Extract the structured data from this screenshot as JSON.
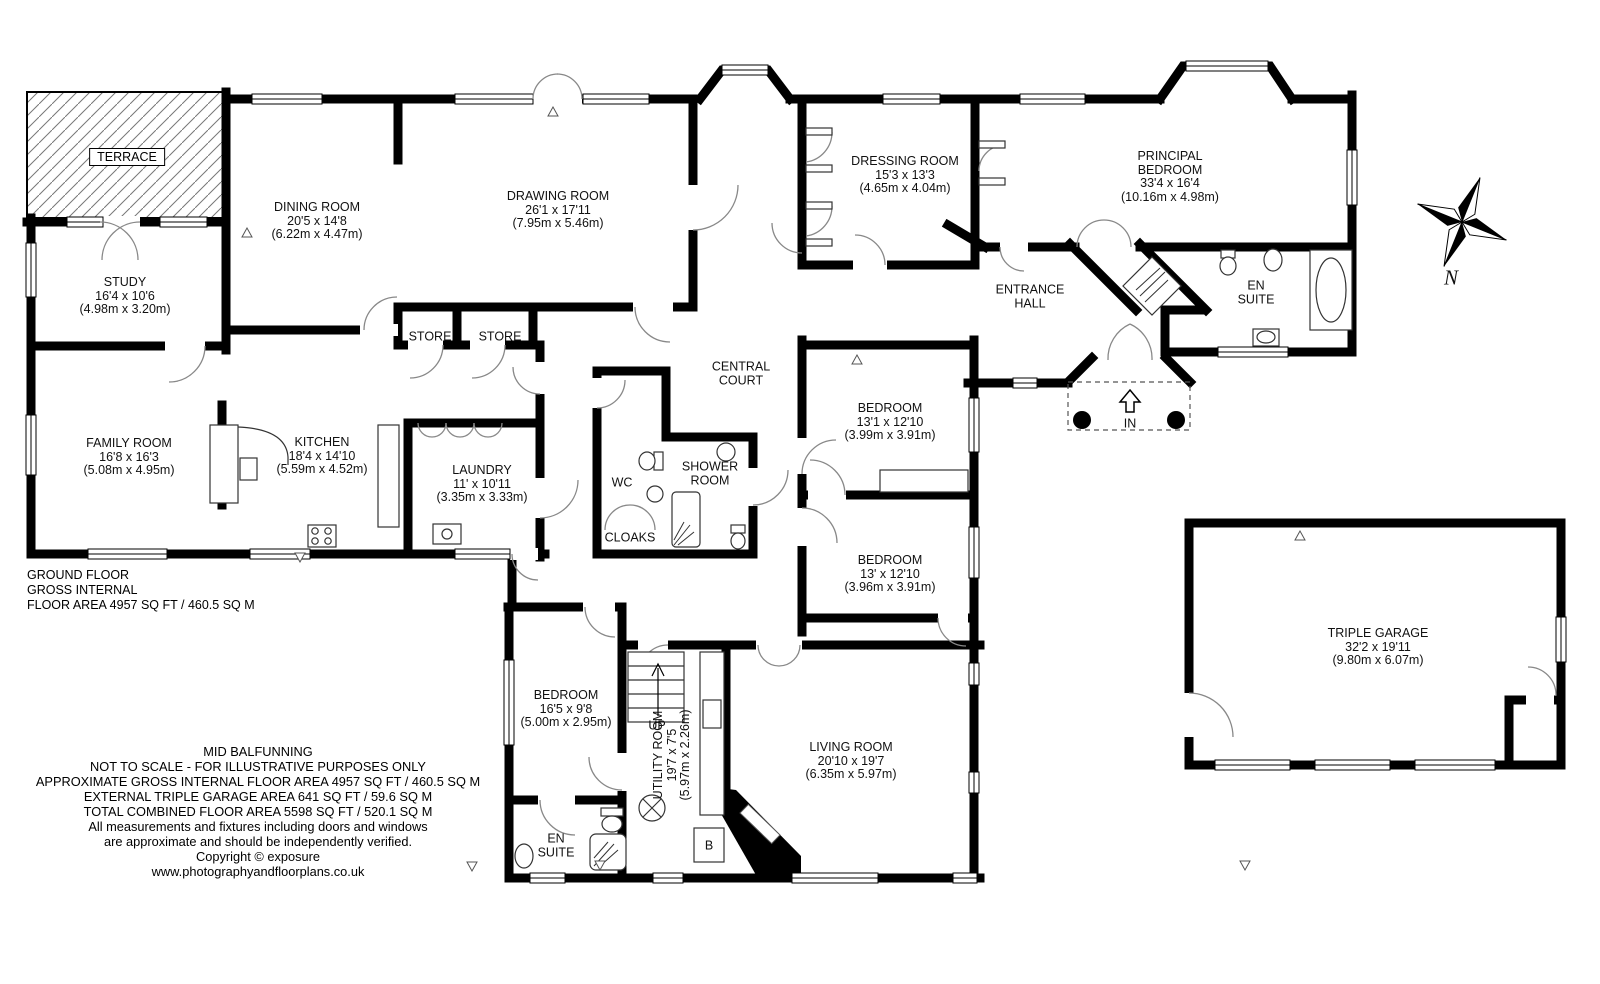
{
  "terrace": {
    "label": "TERRACE"
  },
  "rooms": {
    "study": {
      "name": "STUDY",
      "imperial": "16'4 x 10'6",
      "metric": "(4.98m x 3.20m)"
    },
    "dining_room": {
      "name": "DINING ROOM",
      "imperial": "20'5 x 14'8",
      "metric": "(6.22m x 4.47m)"
    },
    "drawing_room": {
      "name": "DRAWING ROOM",
      "imperial": "26'1 x 17'11",
      "metric": "(7.95m x 5.46m)"
    },
    "store_1": {
      "name": "STORE"
    },
    "store_2": {
      "name": "STORE"
    },
    "family_room": {
      "name": "FAMILY ROOM",
      "imperial": "16'8 x 16'3",
      "metric": "(5.08m x 4.95m)"
    },
    "kitchen": {
      "name": "KITCHEN",
      "imperial": "18'4 x 14'10",
      "metric": "(5.59m x 4.52m)"
    },
    "laundry": {
      "name": "LAUNDRY",
      "imperial": "11' x 10'11",
      "metric": "(3.35m x 3.33m)"
    },
    "wc": {
      "name": "WC"
    },
    "cloaks": {
      "name": "CLOAKS"
    },
    "shower_room": {
      "name": "SHOWER ROOM"
    },
    "central_court": {
      "name": "CENTRAL COURT"
    },
    "dressing_room": {
      "name": "DRESSING ROOM",
      "imperial": "15'3 x 13'3",
      "metric": "(4.65m x 4.04m)"
    },
    "principal_bedroom": {
      "name": "PRINCIPAL BEDROOM",
      "imperial": "33'4 x 16'4",
      "metric": "(10.16m x 4.98m)"
    },
    "entrance_hall": {
      "name": "ENTRANCE HALL"
    },
    "en_suite_principal": {
      "name": "EN SUITE"
    },
    "bedroom_2": {
      "name": "BEDROOM",
      "imperial": "13'1 x 12'10",
      "metric": "(3.99m x 3.91m)"
    },
    "bedroom_3": {
      "name": "BEDROOM",
      "imperial": "13' x 12'10",
      "metric": "(3.96m x 3.91m)"
    },
    "bedroom_4": {
      "name": "BEDROOM",
      "imperial": "16'5 x 9'8",
      "metric": "(5.00m x 2.95m)"
    },
    "en_suite_guest": {
      "name": "EN SUITE"
    },
    "utility_room": {
      "name": "UTILITY ROOM",
      "imperial": "19'7 x 7'5",
      "metric": "(5.97m x 2.26m)"
    },
    "living_room": {
      "name": "LIVING ROOM",
      "imperial": "20'10 x 19'7",
      "metric": "(6.35m x 5.97m)"
    },
    "triple_garage": {
      "name": "TRIPLE GARAGE",
      "imperial": "32'2 x 19'11",
      "metric": "(9.80m x 6.07m)"
    }
  },
  "markers": {
    "up": "UP",
    "in": "IN",
    "boiler": "B",
    "north": "N"
  },
  "floor_summary": {
    "line1": "GROUND FLOOR",
    "line2": "GROSS INTERNAL",
    "line3": "FLOOR AREA 4957 SQ FT / 460.5 SQ M"
  },
  "footer": {
    "property_name": "MID BALFUNNING",
    "scale_note": "NOT TO SCALE - FOR ILLUSTRATIVE PURPOSES ONLY",
    "gross_internal": "APPROXIMATE GROSS INTERNAL FLOOR AREA 4957 SQ FT / 460.5 SQ M",
    "garage_area": "EXTERNAL TRIPLE GARAGE AREA 641 SQ FT / 59.6 SQ M",
    "total_area": "TOTAL COMBINED FLOOR AREA 5598 SQ FT / 520.1 SQ M",
    "note_1": "All measurements and fixtures including doors and windows",
    "note_2": "are approximate and should be independently verified.",
    "copyright": "Copyright © exposure",
    "website": "www.photographyandfloorplans.co.uk"
  },
  "colors": {
    "walls": "#000000",
    "background": "#ffffff",
    "door_arc": "#888888"
  }
}
